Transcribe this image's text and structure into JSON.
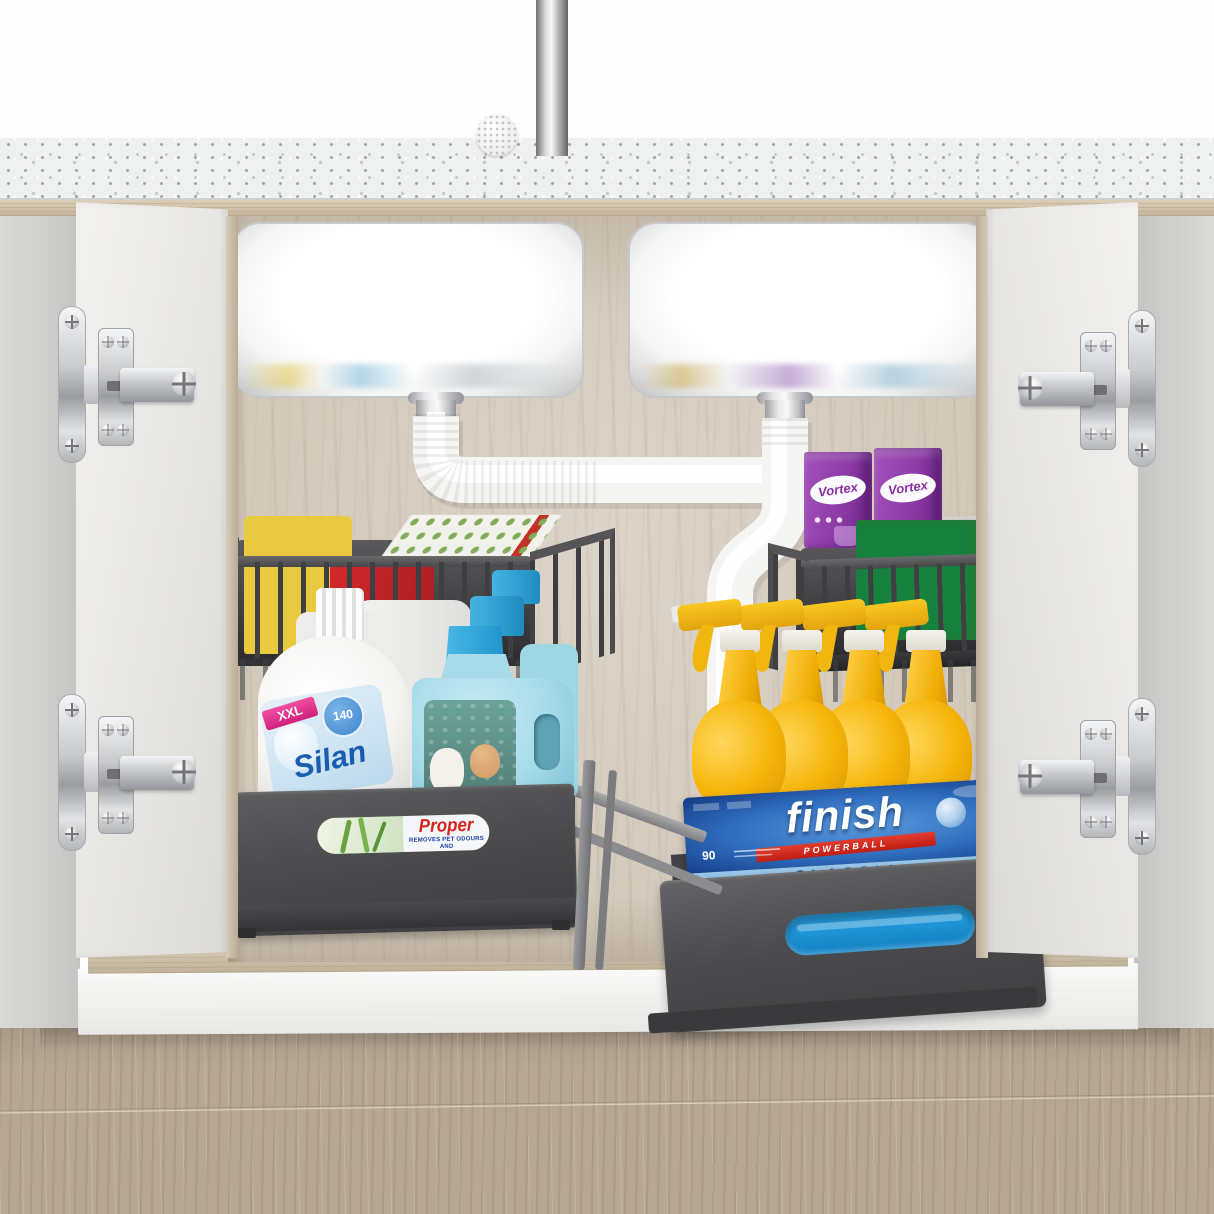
{
  "products": {
    "silan": {
      "badge": "XXL",
      "count": "140",
      "brand": "Silan"
    },
    "mr_proper": {
      "brand": "Proper",
      "tagline": "REMOVES PET ODOURS AND"
    },
    "finish": {
      "brand": "finish",
      "banner": "POWERBALL",
      "count": "90",
      "variant": "CLASSIC"
    },
    "vortex": {
      "brand": "Vortex"
    }
  },
  "colors": {
    "organizer_gray": "#48484a",
    "sponge_yellow": "#e9c93f",
    "sponge_green": "#17813f",
    "vortex_purple": "#8c3aa6",
    "finish_blue": "#2e6cbc",
    "finish_light_band": "#9cc9ea",
    "spray_yellow": "#f6b60b",
    "proper_cyan": "#a7dbe9",
    "silan_blue": "#1a5cb0",
    "silan_pink": "#e02e8a",
    "pipe_white": "#f5f5f3",
    "wood_back": "#d3c9bb",
    "countertop": "#eff0f0",
    "floor_taupe": "#b6a795"
  }
}
